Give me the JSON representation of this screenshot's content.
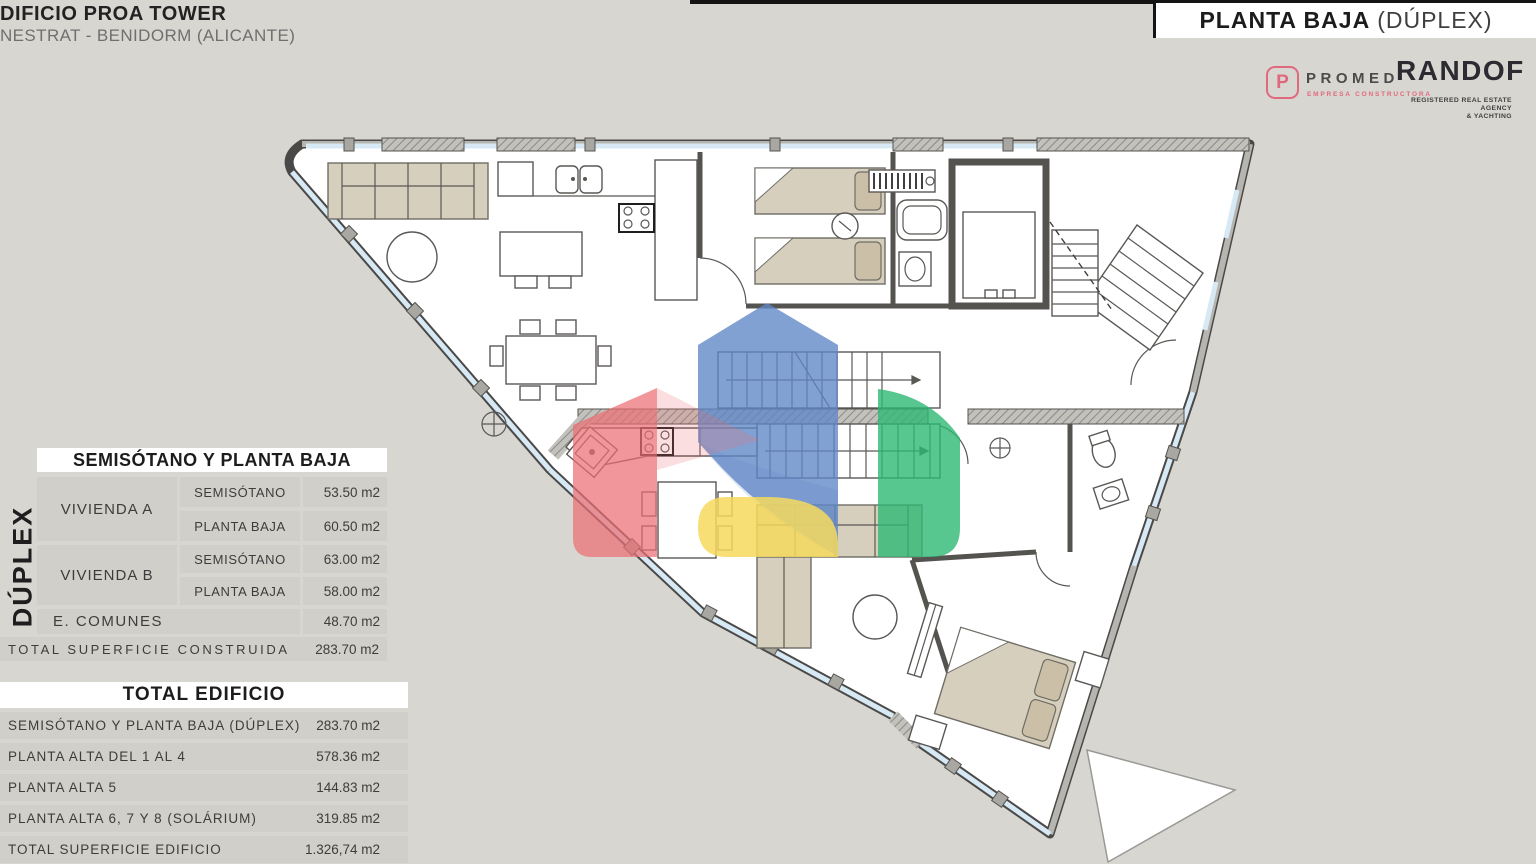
{
  "header": {
    "title": "DIFICIO PROA TOWER",
    "subtitle": "NESTRAT - BENIDORM (ALICANTE)"
  },
  "banner": {
    "title": "PLANTA BAJA",
    "subtitle": "(DÚPLEX)"
  },
  "logos": {
    "promed": {
      "monogram": "P",
      "name": "PROMED",
      "tagline": "EMPRESA CONSTRUCTORA"
    },
    "randof": {
      "name": "RANDOF",
      "tagline1": "REGISTERED REAL ESTATE AGENCY",
      "tagline2": "& YACHTING"
    }
  },
  "duplex_label": "DÚPLEX",
  "table_semisotano": {
    "title": "SEMISÓTANO Y PLANTA BAJA",
    "groups": [
      {
        "label": "VIVIENDA A",
        "rows": [
          {
            "level": "SEMISÓTANO",
            "area": "53.50 m2"
          },
          {
            "level": "PLANTA BAJA",
            "area": "60.50 m2"
          }
        ]
      },
      {
        "label": "VIVIENDA B",
        "rows": [
          {
            "level": "SEMISÓTANO",
            "area": "63.00 m2"
          },
          {
            "level": "PLANTA BAJA",
            "area": "58.00 m2"
          }
        ]
      }
    ],
    "comunes": {
      "label": "E. COMUNES",
      "area": "48.70 m2"
    },
    "total": {
      "label": "TOTAL SUPERFICIE CONSTRUIDA",
      "area": "283.70 m2"
    }
  },
  "table_edificio": {
    "title": "TOTAL EDIFICIO",
    "rows": [
      {
        "label": "SEMISÓTANO Y PLANTA BAJA (DÚPLEX)",
        "area": "283.70 m2"
      },
      {
        "label": "PLANTA ALTA DEL 1 AL 4",
        "area": "578.36 m2"
      },
      {
        "label": "PLANTA ALTA 5",
        "area": "144.83 m2"
      },
      {
        "label": "PLANTA ALTA 6, 7 Y 8 (SOLÁRIUM)",
        "area": "319.85 m2"
      },
      {
        "label": "TOTAL SUPERFICIE EDIFICIO",
        "area": "1.326,74 m2"
      }
    ]
  },
  "theme": {
    "pink": "#e0697e",
    "dark": "#2c2b31",
    "bg": "#d8d6d1",
    "cell": "#d1cfc9",
    "glass": "#d6e9f4",
    "furn": "#d7cfbe"
  },
  "watermark": {
    "colors": {
      "blue": "#5f87c7",
      "red": "#ec6f74",
      "yellow": "#f6d95e",
      "green": "#2eb873"
    }
  }
}
